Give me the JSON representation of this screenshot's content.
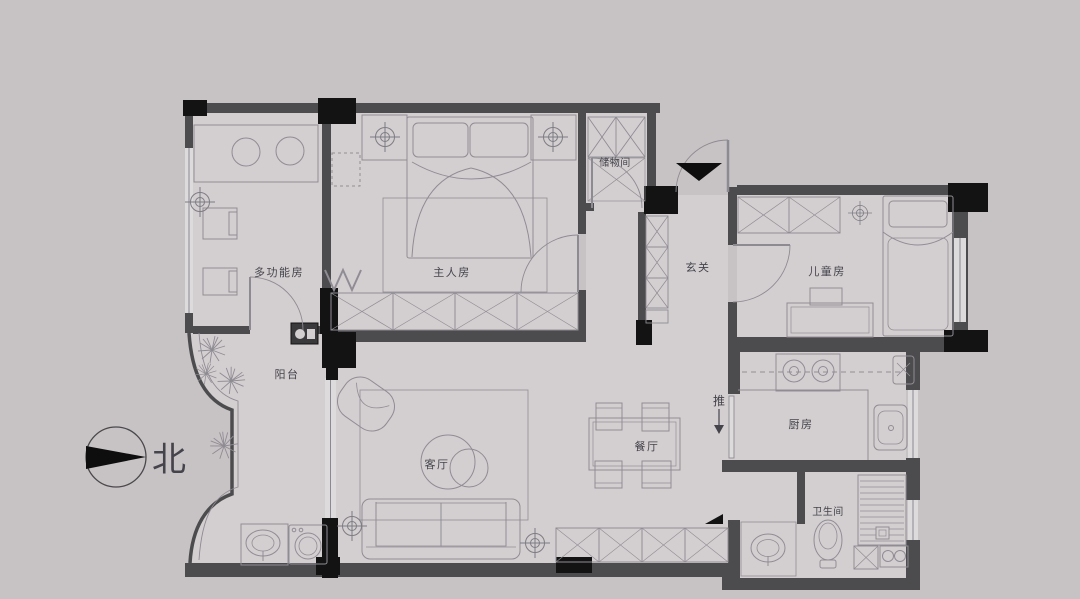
{
  "plan": {
    "type": "apartment-floor-plan",
    "compass": {
      "north_label": "北"
    },
    "annotations": {
      "push_door": "推"
    },
    "rooms": [
      {
        "id": "multifunction-room",
        "label": "多功能房"
      },
      {
        "id": "master-bedroom",
        "label": "主人房"
      },
      {
        "id": "storage-room",
        "label": "储物间"
      },
      {
        "id": "foyer",
        "label": "玄关"
      },
      {
        "id": "kids-room",
        "label": "儿童房"
      },
      {
        "id": "balcony",
        "label": "阳台"
      },
      {
        "id": "living-room",
        "label": "客厅"
      },
      {
        "id": "dining-room",
        "label": "餐厅"
      },
      {
        "id": "kitchen",
        "label": "厨房"
      },
      {
        "id": "bathroom",
        "label": "卫生间"
      }
    ],
    "colors": {
      "background": "#c7c3c4",
      "floor": "#d3cfd0",
      "wall": "#4c4b4d",
      "column": "#131313",
      "furniture_line": "#908c94",
      "window_fill": "#dedbdc",
      "text": "#45434b"
    }
  }
}
